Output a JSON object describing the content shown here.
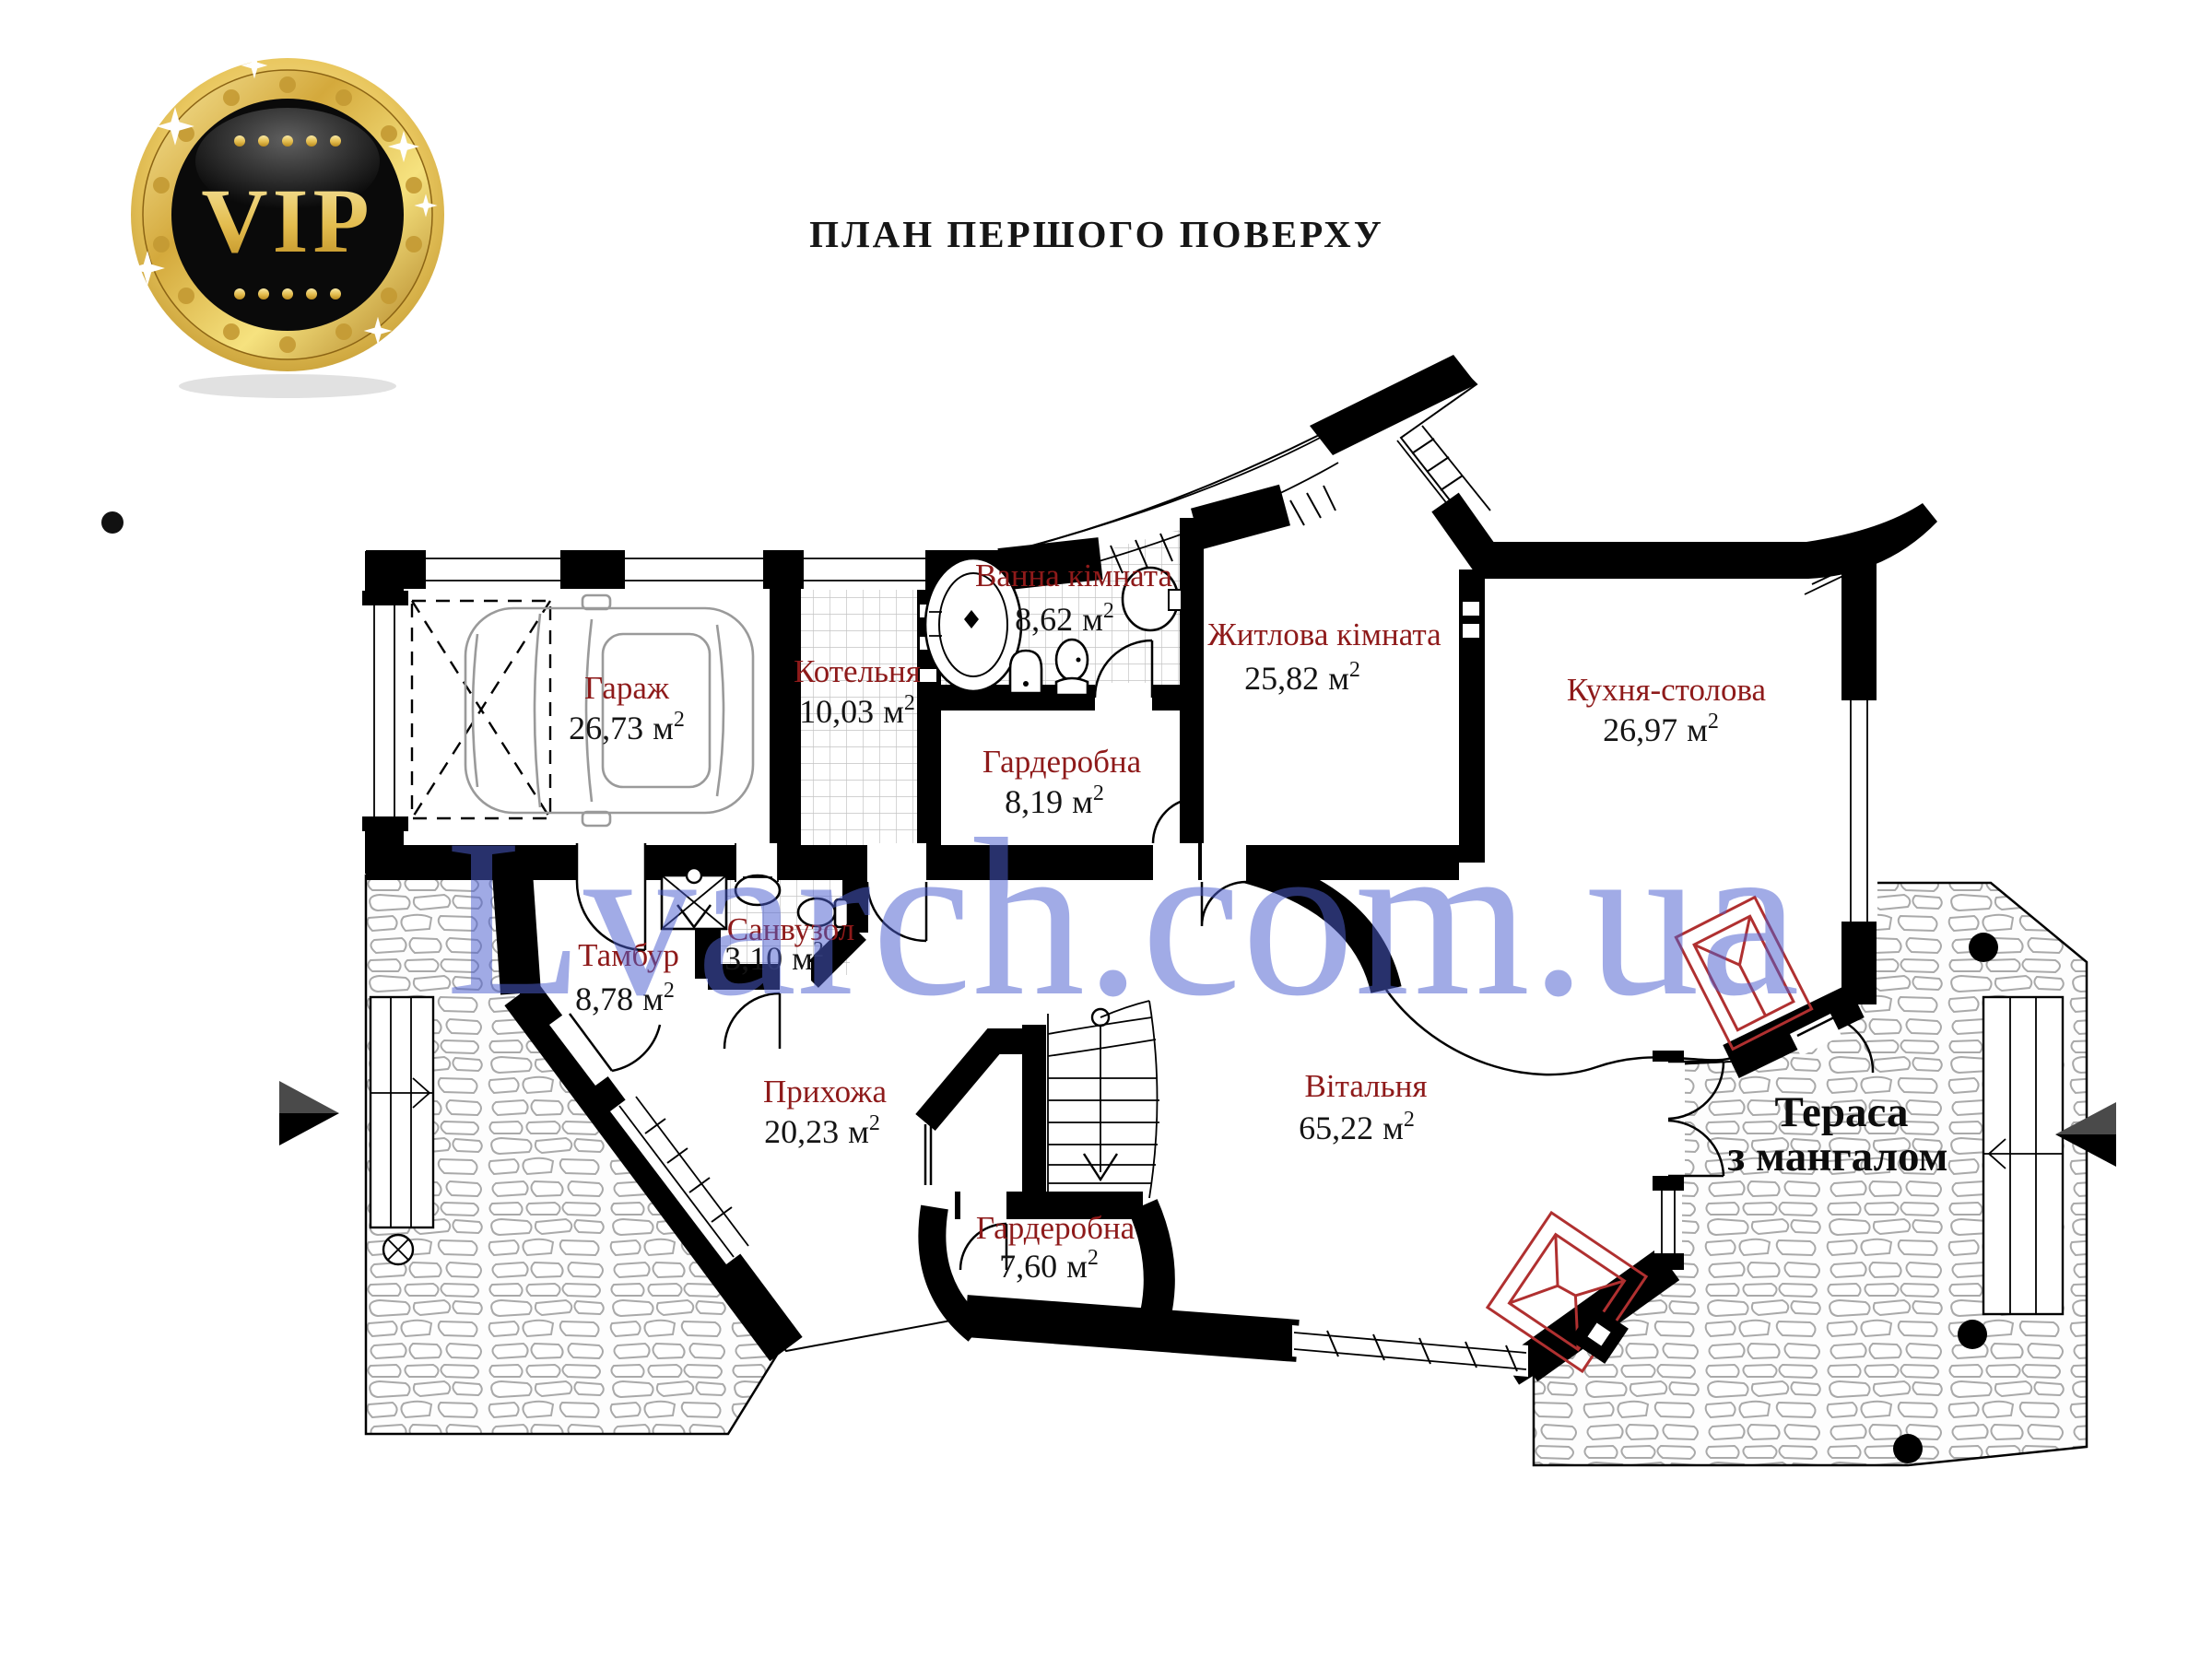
{
  "badge": {
    "label": "VIP"
  },
  "header": {
    "title": "ПЛАН ПЕРШОГО ПОВЕРХУ"
  },
  "watermark": {
    "text": "Lvarch.com.ua",
    "color": "#4d5fd0"
  },
  "units": {
    "unit_suffix": "м",
    "sup": "2"
  },
  "rooms": [
    {
      "id": "garage",
      "name": "Гараж",
      "area": "26,73"
    },
    {
      "id": "boiler",
      "name": "Котельня",
      "area": "10,03"
    },
    {
      "id": "bathroom",
      "name": "Ванна кімната",
      "area": "8,62"
    },
    {
      "id": "wardrobe1",
      "name": "Гардеробна",
      "area": "8,19"
    },
    {
      "id": "livingroom1",
      "name": "Житлова кімната",
      "area": "25,82"
    },
    {
      "id": "kitchen",
      "name": "Кухня-столова",
      "area": "26,97"
    },
    {
      "id": "vestibule",
      "name": "Тамбур",
      "area": "8,78"
    },
    {
      "id": "wc",
      "name": "Санвузол",
      "area": "3,10"
    },
    {
      "id": "hallway",
      "name": "Прихожа",
      "area": "20,23"
    },
    {
      "id": "greatroom",
      "name": "Вітальня",
      "area": "65,22"
    },
    {
      "id": "wardrobe2",
      "name": "Гардеробна",
      "area": "7,60"
    }
  ],
  "terrace": {
    "line1": "Тераса",
    "line2": "з мангалом"
  },
  "colors": {
    "room_label": "#8e1a1a",
    "area_text": "#141414",
    "wall": "#000000",
    "gold": "#d4a93c"
  }
}
